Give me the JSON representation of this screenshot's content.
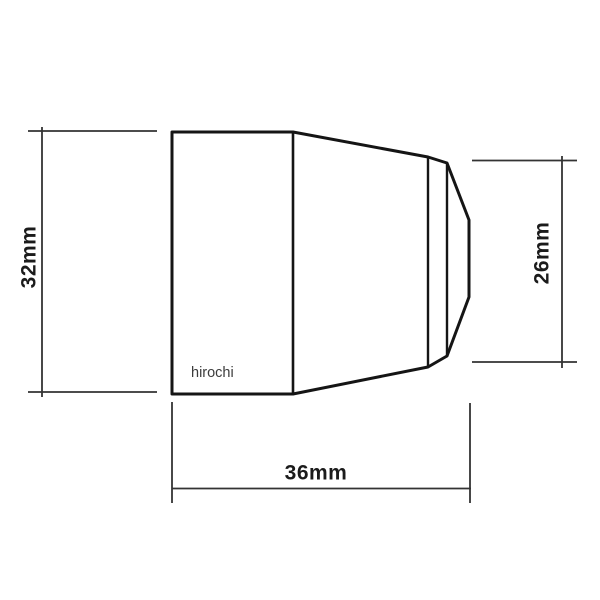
{
  "canvas": {
    "width": 600,
    "height": 600,
    "background": "#ffffff"
  },
  "drawing": {
    "kind": "technical-drawing-side-view",
    "part": "tapered-cap",
    "watermark": "hirochi",
    "colors": {
      "outline": "#151515",
      "inner_line": "#1c1c1c",
      "dimension_line": "#333333",
      "label_text": "#1b1b1b",
      "watermark_text": "#3c3c3c"
    },
    "dimensions": {
      "overall_height": {
        "label": "32mm",
        "value": 32,
        "unit": "mm",
        "side": "left"
      },
      "tip_height": {
        "label": "26mm",
        "value": 26,
        "unit": "mm",
        "side": "right"
      },
      "overall_length": {
        "label": "36mm",
        "value": 36,
        "unit": "mm",
        "side": "bottom"
      }
    }
  }
}
